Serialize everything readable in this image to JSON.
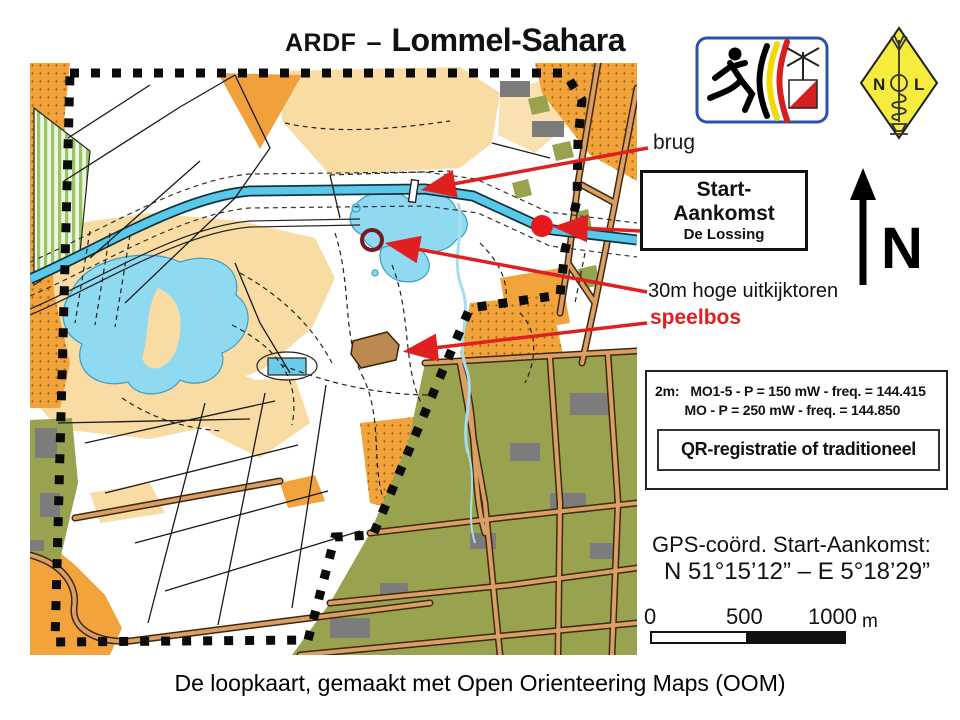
{
  "title": {
    "prefix": "ARDF",
    "dash": "–",
    "name": "Lommel-Sahara"
  },
  "map_labels": {
    "brug": "brug",
    "uitkijktoren": "30m hoge uitkijktoren",
    "speelbos": "speelbos"
  },
  "start_box": {
    "line1": "Start-",
    "line2": "Aankomst",
    "line3": "De Lossing"
  },
  "north": {
    "label": "N"
  },
  "frequency_box": {
    "line1": "2m:   MO1-5 - P = 150 mW - freq. = 144.415",
    "line2": "        MO - P = 250 mW - freq. = 144.850",
    "registration": "QR-registratie of traditioneel"
  },
  "gps": {
    "label": "GPS-coörd. Start-Aankomst:",
    "coordinates": "N 51°15’12” – E 5°18’29”"
  },
  "scale_bar": {
    "ticks": [
      "0",
      "500",
      "1000"
    ],
    "unit": "m"
  },
  "caption": "De loopkaart, gemaakt met Open Orienteering Maps (OOM)",
  "logos": {
    "ardf": "ARDF runner with Belgian stripes and orienteering flag",
    "nol": "NOL amateur radio club yellow diamond"
  },
  "colors": {
    "accent_red": "#e02020",
    "start_dot_red": "#e8191c",
    "tower_circle_maroon": "#7a1822",
    "canal_blue": "#58c9e9",
    "lake_blue": "#8fd9f1",
    "open_orange": "#f2a33c",
    "rough_tan": "#f8dca4",
    "urban_olive": "#99a24f",
    "building_gray": "#7c7c7c",
    "road_brown": "#d9a066"
  }
}
